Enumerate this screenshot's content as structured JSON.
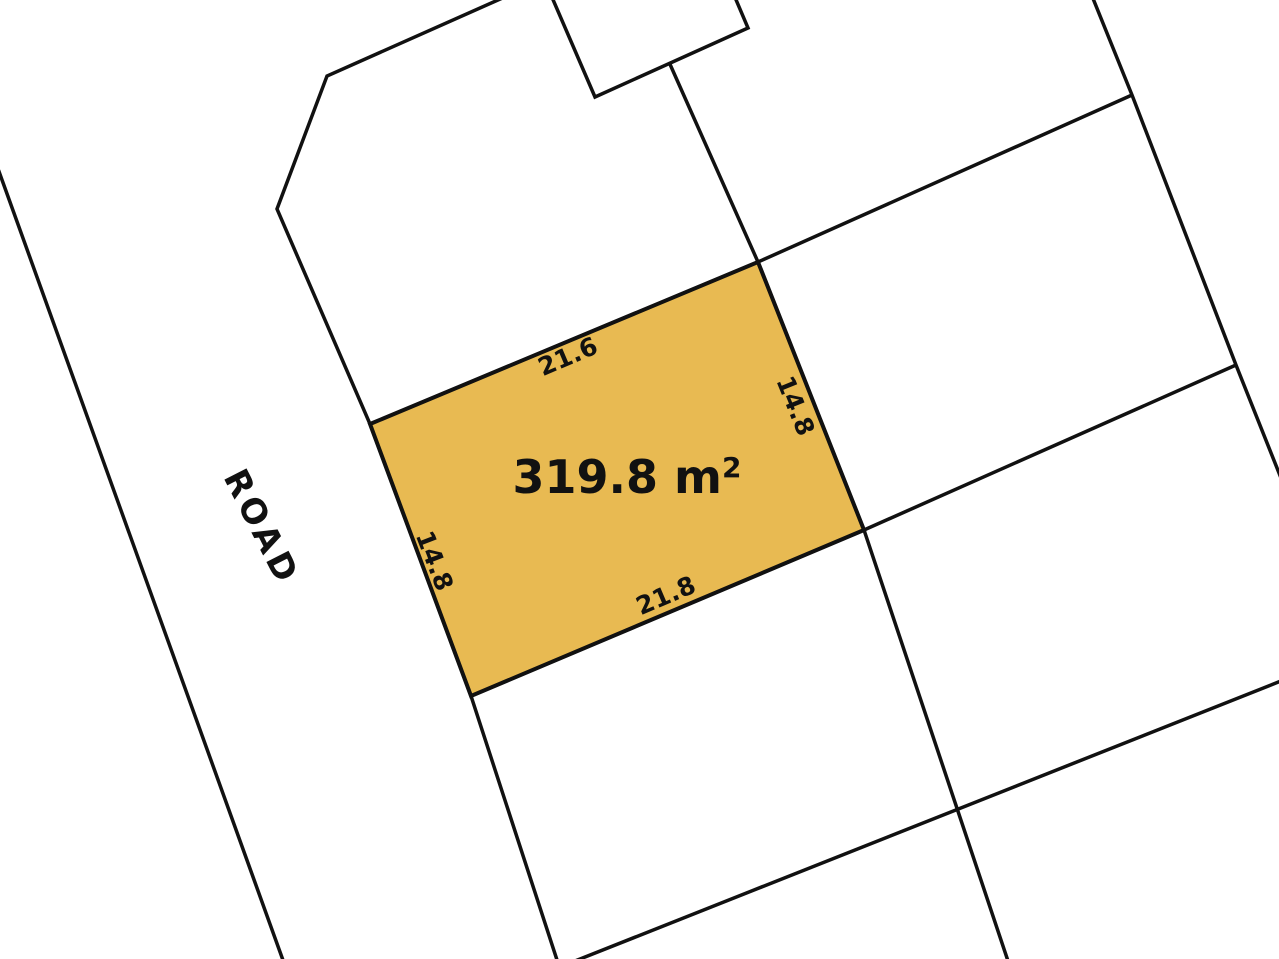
{
  "map": {
    "background_color": "#ffffff",
    "line_color": "#111111",
    "text_color": "#111111",
    "road": {
      "label": "ROAD"
    },
    "highlighted_lot": {
      "fill_color": "#e8ba52",
      "area_text": "319.8 m",
      "area_superscript": "2",
      "dimensions": {
        "top": "21.6",
        "right": "14.8",
        "bottom": "21.8",
        "left": "14.8"
      }
    }
  }
}
